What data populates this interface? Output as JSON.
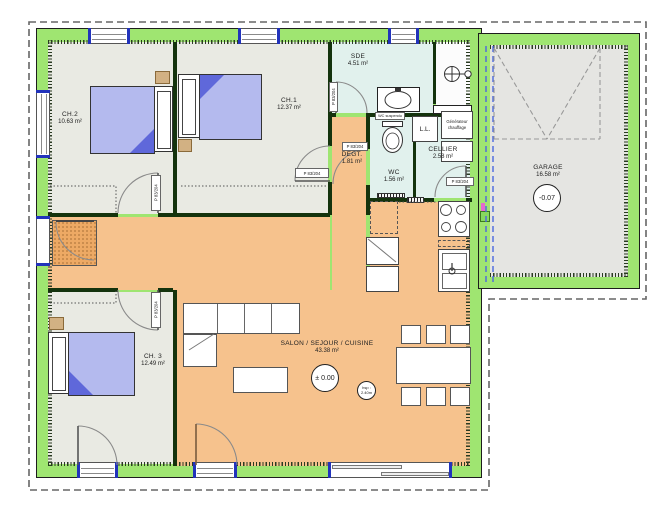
{
  "plan_title": "floor-plan",
  "rooms": {
    "ch2": {
      "name": "CH.2",
      "area": "10.63 m²"
    },
    "ch1": {
      "name": "CH.1",
      "area": "12.37 m²"
    },
    "ch3": {
      "name": "CH. 3",
      "area": "12.49 m²"
    },
    "sde": {
      "name": "SDE",
      "area": "4.51 m²"
    },
    "wc": {
      "name": "WC",
      "area": "1.56 m²"
    },
    "degt": {
      "name": "DEGT.",
      "area": "1.81 m²"
    },
    "cellier": {
      "name": "CELLIER",
      "area": "2.58 m²"
    },
    "salon": {
      "name": "SALON / SEJOUR / CUISINE",
      "area": "43.38 m²"
    },
    "garage": {
      "name": "GARAGE",
      "area": "16.58 m²"
    }
  },
  "levels": {
    "salon": "± 0.00",
    "garage": "-0.07"
  },
  "ceiling": {
    "line1": "hsp :",
    "line2": "2.40m"
  },
  "door_label": "P 83/204",
  "equipment": {
    "washer": "L.L.",
    "heater_line1": "Générateur",
    "heater_line2": "chauffage",
    "wc_note": "WC suspendu"
  },
  "colors": {
    "exterior_wall": "#9fe571",
    "living_floor": "#f6c28d",
    "bedroom_floor": "#e9eae3",
    "wet_floor": "#e1f1ed",
    "garage_floor": "#e5e5e2",
    "bed_blanket": "#b4baee",
    "bed_fold": "#5f68da",
    "nightstand": "#d2b183",
    "window_post": "#2233bb",
    "garage_divider": "#4a66e0"
  }
}
